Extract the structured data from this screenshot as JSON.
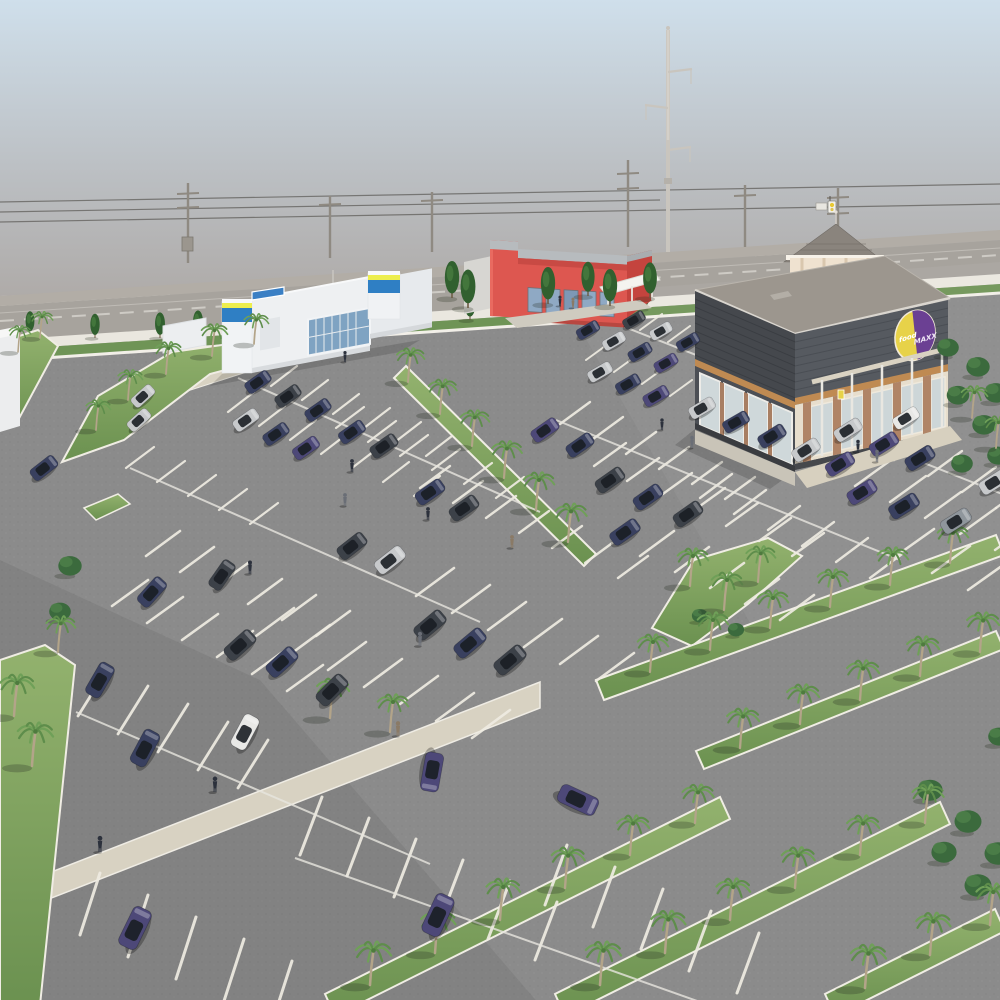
{
  "meta": {
    "title": "Aerial 3D architectural rendering of a retail center with palm-lined parking lot",
    "scene_type": "3d-render"
  },
  "buildings": {
    "grocery": {
      "logo_text_1": "food",
      "logo_text_2": "MAXX",
      "wall_color": "#45484d",
      "trim_color": "#bf8a52",
      "logo_yellow": "#e7d249",
      "logo_purple": "#6b4093"
    },
    "red_retail": {
      "wall_color": "#dd5750",
      "parapet_color": "#b7bbbe"
    },
    "left_retail": {
      "wall_color": "#eef0f2",
      "accent_blue": "#2f7fc4",
      "accent_yellow": "#edee4e"
    }
  },
  "palette": {
    "sky_top": "#cfdfeb",
    "sky_horizon": "#a79f99",
    "asphalt": "#8b8b8b",
    "grass_light": "#93b26e",
    "grass_dark": "#6b9150",
    "curb": "#f0ede4",
    "walkway_tan": "#d8d2c2",
    "street": "#a7a39d",
    "sidewalk": "#eae7df",
    "hedge": "#6f9456",
    "car_colors": {
      "n": "#39405f",
      "p": "#4d4878",
      "d": "#3c4148",
      "s": "#c7c9cb",
      "w": "#e8e8e6",
      "g": "#8f969c"
    },
    "people_colors": {
      "d": "#2c313c",
      "g": "#6a6e76",
      "t": "#8a7a66"
    }
  },
  "objects": {
    "wires": [
      [
        0,
        202,
        1000,
        184
      ],
      [
        0,
        222,
        1000,
        204
      ],
      [
        0,
        212,
        660,
        200
      ]
    ],
    "utility_poles": [
      {
        "x": 188,
        "t": 183,
        "b": 263,
        "arms": [
          194,
          208
        ],
        "box": true
      },
      {
        "x": 330,
        "t": 196,
        "b": 258,
        "arms": [
          205
        ]
      },
      {
        "x": 432,
        "t": 192,
        "b": 252,
        "arms": [
          201
        ]
      },
      {
        "x": 628,
        "t": 160,
        "b": 247,
        "arms": [
          174,
          189
        ]
      },
      {
        "x": 745,
        "t": 185,
        "b": 247,
        "arms": [
          196
        ]
      },
      {
        "x": 838,
        "t": 188,
        "b": 252,
        "arms": [
          198,
          214
        ]
      }
    ],
    "street_trees": [
      [
        30,
        334,
        0.8
      ],
      [
        95,
        338,
        0.85
      ],
      [
        160,
        338,
        0.9
      ],
      [
        198,
        336,
        0.9
      ],
      [
        266,
        332,
        0.9
      ],
      [
        334,
        328,
        0.9
      ],
      [
        402,
        324,
        0.92
      ],
      [
        470,
        320,
        0.95
      ],
      [
        538,
        316,
        0.95
      ],
      [
        606,
        312,
        0.9
      ],
      [
        645,
        309,
        0.9
      ]
    ],
    "accent_trees": [
      [
        452,
        298,
        1.3,
        "c"
      ],
      [
        468,
        308,
        1.35,
        "c"
      ],
      [
        548,
        304,
        1.3,
        "c"
      ],
      [
        588,
        296,
        1.2,
        "c"
      ],
      [
        610,
        306,
        1.3,
        "c"
      ],
      [
        650,
        298,
        1.25,
        "c"
      ],
      [
        948,
        356,
        1.2,
        "b"
      ],
      [
        978,
        376,
        1.3,
        "b"
      ],
      [
        996,
        402,
        1.3,
        "b"
      ],
      [
        958,
        404,
        1.25,
        "b"
      ],
      [
        984,
        434,
        1.3,
        "b"
      ],
      [
        998,
        464,
        1.2,
        "b"
      ],
      [
        962,
        472,
        1.2,
        "b"
      ],
      [
        930,
        800,
        1.4,
        "b"
      ],
      [
        968,
        832,
        1.5,
        "b"
      ],
      [
        998,
        864,
        1.5,
        "b"
      ],
      [
        944,
        862,
        1.4,
        "b"
      ],
      [
        978,
        896,
        1.5,
        "b"
      ],
      [
        999,
        745,
        1.2,
        "b"
      ],
      [
        700,
        622,
        0.9,
        "b"
      ],
      [
        736,
        636,
        0.9,
        "b"
      ],
      [
        70,
        575,
        1.3,
        "b"
      ],
      [
        60,
        620,
        1.2,
        "b"
      ]
    ],
    "palms": [
      [
        18,
        352,
        0.7
      ],
      [
        40,
        338,
        0.7
      ],
      [
        96,
        430,
        0.8
      ],
      [
        128,
        400,
        0.8
      ],
      [
        166,
        374,
        0.85
      ],
      [
        212,
        356,
        0.85
      ],
      [
        254,
        344,
        0.8
      ],
      [
        408,
        382,
        0.9
      ],
      [
        440,
        414,
        0.92
      ],
      [
        472,
        446,
        0.95
      ],
      [
        504,
        478,
        0.98
      ],
      [
        536,
        510,
        1
      ],
      [
        568,
        542,
        1.02
      ],
      [
        690,
        586,
        1
      ],
      [
        724,
        610,
        1
      ],
      [
        758,
        582,
        0.95
      ],
      [
        14,
        716,
        1.1
      ],
      [
        32,
        766,
        1.15
      ],
      [
        58,
        652,
        0.95
      ],
      [
        330,
        718,
        1.05
      ],
      [
        390,
        732,
        1
      ],
      [
        650,
        672,
        1
      ],
      [
        710,
        650,
        1
      ],
      [
        770,
        628,
        1
      ],
      [
        830,
        607,
        1
      ],
      [
        890,
        585,
        1
      ],
      [
        950,
        563,
        1
      ],
      [
        740,
        748,
        1.05
      ],
      [
        800,
        724,
        1.05
      ],
      [
        860,
        700,
        1.05
      ],
      [
        920,
        676,
        1.05
      ],
      [
        980,
        652,
        1.05
      ],
      [
        370,
        985,
        1.15
      ],
      [
        435,
        953,
        1.12
      ],
      [
        500,
        920,
        1.1
      ],
      [
        565,
        888,
        1.08
      ],
      [
        630,
        855,
        1.05
      ],
      [
        695,
        823,
        1.02
      ],
      [
        600,
        985,
        1.15
      ],
      [
        665,
        953,
        1.12
      ],
      [
        730,
        920,
        1.1
      ],
      [
        795,
        888,
        1.08
      ],
      [
        860,
        855,
        1.05
      ],
      [
        925,
        823,
        1.02
      ],
      [
        865,
        988,
        1.15
      ],
      [
        930,
        955,
        1.12
      ],
      [
        990,
        925,
        1.1
      ],
      [
        972,
        418,
        0.85
      ],
      [
        996,
        448,
        0.85
      ]
    ],
    "cars": [
      [
        258,
        382,
        -35,
        0.8,
        "n"
      ],
      [
        288,
        396,
        -35,
        0.8,
        "d"
      ],
      [
        318,
        410,
        -35,
        0.8,
        "n"
      ],
      [
        246,
        420,
        -35,
        0.8,
        "s"
      ],
      [
        276,
        434,
        -35,
        0.8,
        "n"
      ],
      [
        306,
        448,
        -35,
        0.82,
        "p"
      ],
      [
        352,
        432,
        -35,
        0.82,
        "n"
      ],
      [
        384,
        446,
        -35,
        0.85,
        "d"
      ],
      [
        143,
        396,
        -42,
        0.75,
        "s"
      ],
      [
        139,
        420,
        -42,
        0.75,
        "s"
      ],
      [
        44,
        468,
        -38,
        0.85,
        "n"
      ],
      [
        430,
        492,
        -35,
        0.9,
        "n"
      ],
      [
        464,
        508,
        -35,
        0.9,
        "d"
      ],
      [
        390,
        560,
        -38,
        0.95,
        "s"
      ],
      [
        352,
        546,
        -38,
        0.92,
        "d"
      ],
      [
        222,
        575,
        -55,
        0.92,
        "d"
      ],
      [
        152,
        592,
        -48,
        0.95,
        "n"
      ],
      [
        240,
        645,
        -42,
        1,
        "d"
      ],
      [
        282,
        662,
        -42,
        1,
        "n"
      ],
      [
        430,
        625,
        -40,
        1,
        "d"
      ],
      [
        470,
        643,
        -40,
        1,
        "n"
      ],
      [
        510,
        660,
        -40,
        1,
        "d"
      ],
      [
        545,
        430,
        -35,
        0.85,
        "p"
      ],
      [
        580,
        445,
        -35,
        0.85,
        "n"
      ],
      [
        610,
        480,
        -35,
        0.9,
        "d"
      ],
      [
        648,
        497,
        -35,
        0.9,
        "n"
      ],
      [
        688,
        514,
        -35,
        0.9,
        "d"
      ],
      [
        625,
        532,
        -35,
        0.92,
        "n"
      ],
      [
        588,
        330,
        -30,
        0.7,
        "n"
      ],
      [
        614,
        341,
        -30,
        0.7,
        "s"
      ],
      [
        640,
        352,
        -30,
        0.72,
        "n"
      ],
      [
        666,
        363,
        -30,
        0.72,
        "p"
      ],
      [
        600,
        372,
        -30,
        0.75,
        "s"
      ],
      [
        628,
        384,
        -30,
        0.75,
        "n"
      ],
      [
        656,
        396,
        -30,
        0.78,
        "p"
      ],
      [
        634,
        320,
        -30,
        0.68,
        "d"
      ],
      [
        661,
        331,
        -30,
        0.68,
        "s"
      ],
      [
        688,
        342,
        -30,
        0.7,
        "n"
      ],
      [
        702,
        408,
        -30,
        0.8,
        "s"
      ],
      [
        736,
        422,
        -30,
        0.8,
        "n"
      ],
      [
        772,
        436,
        -32,
        0.85,
        "n"
      ],
      [
        806,
        450,
        -32,
        0.85,
        "s"
      ],
      [
        840,
        464,
        -32,
        0.88,
        "p"
      ],
      [
        848,
        430,
        -32,
        0.85,
        "s"
      ],
      [
        884,
        444,
        -32,
        0.88,
        "p"
      ],
      [
        920,
        458,
        -32,
        0.9,
        "n"
      ],
      [
        862,
        492,
        -32,
        0.9,
        "p"
      ],
      [
        904,
        506,
        -32,
        0.92,
        "n"
      ],
      [
        956,
        521,
        -32,
        0.92,
        "g"
      ],
      [
        994,
        482,
        -32,
        0.9,
        "s"
      ],
      [
        906,
        418,
        -32,
        0.8,
        "w"
      ],
      [
        100,
        680,
        -60,
        1.05,
        "n"
      ],
      [
        145,
        748,
        -62,
        1.1,
        "n"
      ],
      [
        245,
        732,
        -62,
        1.05,
        "w"
      ],
      [
        332,
        690,
        -45,
        1.02,
        "d"
      ],
      [
        432,
        772,
        100,
        1.15,
        "p"
      ],
      [
        578,
        800,
        25,
        1.2,
        "p"
      ],
      [
        438,
        915,
        -65,
        1.25,
        "p"
      ],
      [
        135,
        928,
        -64,
        1.25,
        "p"
      ]
    ],
    "people": [
      [
        352,
        472,
        1,
        "d"
      ],
      [
        345,
        506,
        1,
        "g"
      ],
      [
        428,
        520,
        1,
        "d"
      ],
      [
        250,
        574,
        1.05,
        "d"
      ],
      [
        420,
        646,
        1.1,
        "g"
      ],
      [
        512,
        548,
        1,
        "t"
      ],
      [
        662,
        430,
        0.9,
        "d"
      ],
      [
        692,
        448,
        0.95,
        "g"
      ],
      [
        345,
        362,
        0.85,
        "d"
      ],
      [
        100,
        852,
        1.25,
        "d"
      ],
      [
        215,
        792,
        1.2,
        "d"
      ],
      [
        398,
        736,
        1.15,
        "t"
      ],
      [
        858,
        452,
        0.95,
        "d"
      ],
      [
        877,
        462,
        0.95,
        "g"
      ],
      [
        560,
        306,
        0.8,
        "d"
      ],
      [
        573,
        308,
        0.8,
        "t"
      ]
    ],
    "stripe_rows": [
      [
        240,
        372,
        7,
        31,
        14,
        26,
        -20,
        2.2
      ],
      [
        228,
        412,
        7,
        31,
        14,
        26,
        -20,
        2.2
      ],
      [
        336,
        428,
        6,
        32,
        14,
        28,
        -21,
        2.2
      ],
      [
        126,
        468,
        5,
        31,
        14,
        28,
        -21,
        2.2
      ],
      [
        420,
        488,
        7,
        33,
        15,
        30,
        -22,
        2.4
      ],
      [
        560,
        424,
        6,
        33,
        15,
        30,
        -22,
        2.4
      ],
      [
        594,
        466,
        7,
        33,
        15,
        32,
        -23,
        2.4
      ],
      [
        700,
        498,
        6,
        34,
        16,
        32,
        -24,
        2.4
      ],
      [
        826,
        428,
        7,
        34,
        16,
        34,
        -25,
        2.4
      ],
      [
        820,
        470,
        6,
        35,
        16,
        36,
        -26,
        2.4
      ],
      [
        146,
        556,
        6,
        34,
        16,
        34,
        -25,
        2.6
      ],
      [
        112,
        606,
        6,
        35,
        17,
        36,
        -26,
        2.6
      ],
      [
        256,
        636,
        7,
        36,
        17,
        38,
        -28,
        2.6
      ],
      [
        416,
        596,
        6,
        36,
        17,
        38,
        -28,
        2.6
      ],
      [
        78,
        716,
        5,
        40,
        18,
        30,
        -48,
        2.8
      ],
      [
        640,
        556,
        5,
        35,
        16,
        34,
        -25,
        2.6
      ],
      [
        896,
        556,
        4,
        36,
        17,
        38,
        -27,
        2.6
      ],
      [
        300,
        855,
        6,
        47,
        21,
        22,
        -58,
        3
      ],
      [
        80,
        935,
        5,
        48,
        22,
        20,
        -62,
        3
      ],
      [
        545,
        905,
        5,
        48,
        22,
        22,
        -60,
        3
      ],
      [
        612,
        318,
        4,
        28,
        12,
        22,
        -16,
        2
      ],
      [
        586,
        360,
        4,
        28,
        12,
        22,
        -16,
        2
      ]
    ],
    "aisle_lines": [
      [
        238,
        378,
        540,
        512
      ],
      [
        130,
        468,
        480,
        622
      ],
      [
        76,
        712,
        430,
        864
      ],
      [
        556,
        420,
        900,
        560
      ],
      [
        612,
        322,
        770,
        384
      ],
      [
        295,
        858,
        700,
        1002
      ],
      [
        826,
        424,
        1002,
        494
      ]
    ]
  }
}
